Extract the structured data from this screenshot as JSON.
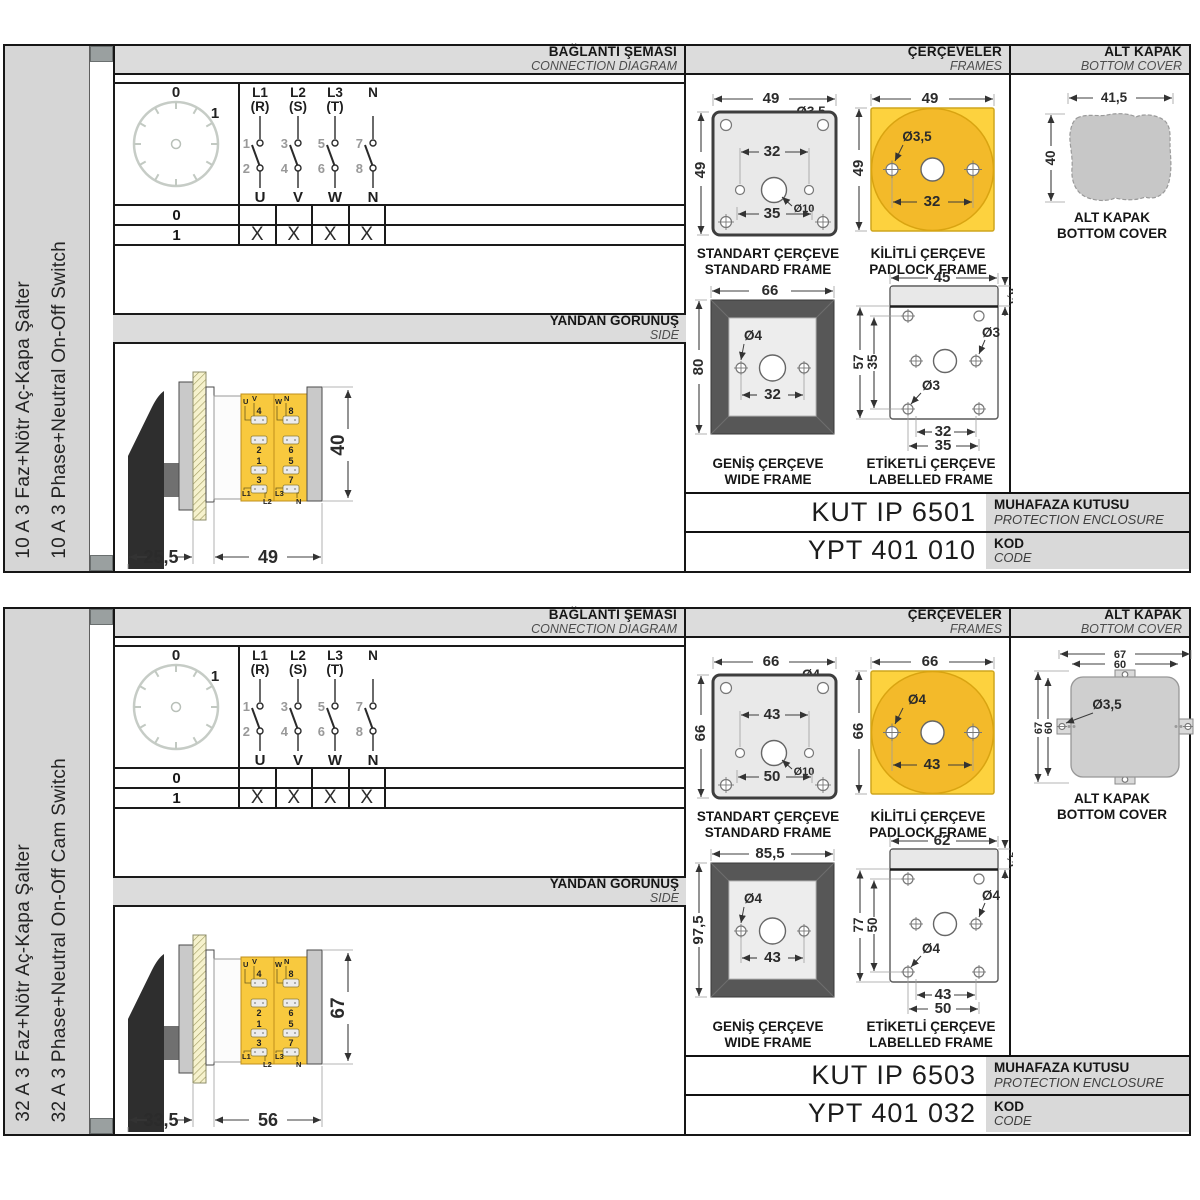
{
  "panels": [
    {
      "sidebar": {
        "title_tr": "10 A 3 Faz+Nötr Aç-Kapa Şalter",
        "title_en": "10 A 3 Phase+Neutral On-Off Switch"
      },
      "headers": {
        "connection_tr": "BAĞLANTI ŞEMASI",
        "connection_en": "CONNECTION DIAGRAM",
        "frames_tr": "ÇERÇEVELER",
        "frames_en": "FRAMES",
        "cover_tr": "ALT KAPAK",
        "cover_en": "BOTTOM COVER",
        "side_tr": "YANDAN GÖRÜNÜŞ",
        "side_en": "SIDE"
      },
      "dial": {
        "pos_off": "0",
        "pos_on": "1"
      },
      "contacts": {
        "phases": [
          {
            "name": "L1",
            "alias": "(R)",
            "n_top": "1",
            "n_bottom": "2",
            "terminal": "U"
          },
          {
            "name": "L2",
            "alias": "(S)",
            "n_top": "3",
            "n_bottom": "4",
            "terminal": "V"
          },
          {
            "name": "L3",
            "alias": "(T)",
            "n_top": "5",
            "n_bottom": "6",
            "terminal": "W"
          },
          {
            "name": "N",
            "alias": "",
            "n_top": "7",
            "n_bottom": "8",
            "terminal": "N"
          }
        ]
      },
      "switch_table": {
        "rows": [
          {
            "label": "0",
            "cells": [
              "",
              "",
              "",
              ""
            ]
          },
          {
            "label": "1",
            "cells": [
              "X",
              "X",
              "X",
              "X"
            ]
          }
        ]
      },
      "side_view": {
        "dim_handle": "25,5",
        "dim_body": "49",
        "dim_height": "40",
        "col1": {
          "top1": "U",
          "top2": "V",
          "n1": "4",
          "n2": "2",
          "n3": "1",
          "n4": "3",
          "b1": "L1",
          "b2": "L2"
        },
        "col2": {
          "top1": "W",
          "top2": "N",
          "n1": "8",
          "n2": "6",
          "n3": "5",
          "n4": "7",
          "b1": "L3",
          "b2": "N"
        }
      },
      "frames": {
        "standard": {
          "w": "49",
          "h": "49",
          "hole": "Ø3,5",
          "inner": "32",
          "outer": "35",
          "center": "Ø10",
          "cap_tr": "STANDART ÇERÇEVE",
          "cap_en": "STANDARD FRAME"
        },
        "padlock": {
          "w": "49",
          "h": "49",
          "hole": "Ø3,5",
          "inner": "32",
          "cap_tr": "KİLİTLİ ÇERÇEVE",
          "cap_en": "PADLOCK FRAME"
        },
        "wide": {
          "w": "66",
          "h": "80",
          "hole": "Ø4",
          "inner": "32",
          "cap_tr": "GENİŞ ÇERÇEVE",
          "cap_en": "WIDE FRAME"
        },
        "labelled": {
          "w": "45",
          "strip": "6,5",
          "h_outer": "57",
          "h_inner": "35",
          "hole_right": "Ø3",
          "hole_bottom": "Ø3",
          "bottom1": "32",
          "bottom2": "35",
          "cap_tr": "ETİKETLİ ÇERÇEVE",
          "cap_en": "LABELLED FRAME"
        }
      },
      "cover": {
        "variant": "blob",
        "w": "41,5",
        "h": "40",
        "cap_tr": "ALT KAPAK",
        "cap_en": "BOTTOM COVER"
      },
      "codes": {
        "enclosure_value": "KUT IP 6501",
        "enclosure_tr": "MUHAFAZA KUTUSU",
        "enclosure_en": "PROTECTION ENCLOSURE",
        "code_value": "YPT 401 010",
        "code_tr": "KOD",
        "code_en": "CODE"
      }
    },
    {
      "sidebar": {
        "title_tr": "32 A 3 Faz+Nötr Aç-Kapa Şalter",
        "title_en": "32 A 3 Phase+Neutral On-Off Cam Switch"
      },
      "headers": {
        "connection_tr": "BAĞLANTI ŞEMASI",
        "connection_en": "CONNECTION DIAGRAM",
        "frames_tr": "ÇERÇEVELER",
        "frames_en": "FRAMES",
        "cover_tr": "ALT KAPAK",
        "cover_en": "BOTTOM COVER",
        "side_tr": "YANDAN GÖRÜNÜŞ",
        "side_en": "SIDE"
      },
      "dial": {
        "pos_off": "0",
        "pos_on": "1"
      },
      "contacts": {
        "phases": [
          {
            "name": "L1",
            "alias": "(R)",
            "n_top": "1",
            "n_bottom": "2",
            "terminal": "U"
          },
          {
            "name": "L2",
            "alias": "(S)",
            "n_top": "3",
            "n_bottom": "4",
            "terminal": "V"
          },
          {
            "name": "L3",
            "alias": "(T)",
            "n_top": "5",
            "n_bottom": "6",
            "terminal": "W"
          },
          {
            "name": "N",
            "alias": "",
            "n_top": "7",
            "n_bottom": "8",
            "terminal": "N"
          }
        ]
      },
      "switch_table": {
        "rows": [
          {
            "label": "0",
            "cells": [
              "",
              "",
              "",
              ""
            ]
          },
          {
            "label": "1",
            "cells": [
              "X",
              "X",
              "X",
              "X"
            ]
          }
        ]
      },
      "side_view": {
        "dim_handle": "33,5",
        "dim_body": "56",
        "dim_height": "67",
        "col1": {
          "top1": "U",
          "top2": "V",
          "n1": "4",
          "n2": "2",
          "n3": "1",
          "n4": "3",
          "b1": "L1",
          "b2": "L2"
        },
        "col2": {
          "top1": "W",
          "top2": "N",
          "n1": "8",
          "n2": "6",
          "n3": "5",
          "n4": "7",
          "b1": "L3",
          "b2": "N"
        }
      },
      "frames": {
        "standard": {
          "w": "66",
          "h": "66",
          "hole": "Ø4",
          "inner": "43",
          "outer": "50",
          "center": "Ø10",
          "cap_tr": "STANDART ÇERÇEVE",
          "cap_en": "STANDARD FRAME"
        },
        "padlock": {
          "w": "66",
          "h": "66",
          "hole": "Ø4",
          "inner": "43",
          "cap_tr": "KİLİTLİ ÇERÇEVE",
          "cap_en": "PADLOCK FRAME"
        },
        "wide": {
          "w": "85,5",
          "h": "97,5",
          "hole": "Ø4",
          "inner": "43",
          "cap_tr": "GENİŞ ÇERÇEVE",
          "cap_en": "WIDE FRAME"
        },
        "labelled": {
          "w": "62",
          "strip": "9,5",
          "h_outer": "77",
          "h_inner": "50",
          "hole_right": "Ø4",
          "hole_bottom": "Ø4",
          "bottom1": "43",
          "bottom2": "50",
          "cap_tr": "ETİKETLİ ÇERÇEVE",
          "cap_en": "LABELLED FRAME"
        }
      },
      "cover": {
        "variant": "tabs",
        "w_outer": "67",
        "w_inner": "60",
        "h_outer": "67",
        "h_inner": "60",
        "hole": "Ø3,5",
        "cap_tr": "ALT KAPAK",
        "cap_en": "BOTTOM COVER"
      },
      "codes": {
        "enclosure_value": "KUT IP 6503",
        "enclosure_tr": "MUHAFAZA KUTUSU",
        "enclosure_en": "PROTECTION ENCLOSURE",
        "code_value": "YPT 401 032",
        "code_tr": "KOD",
        "code_en": "CODE"
      }
    }
  ]
}
